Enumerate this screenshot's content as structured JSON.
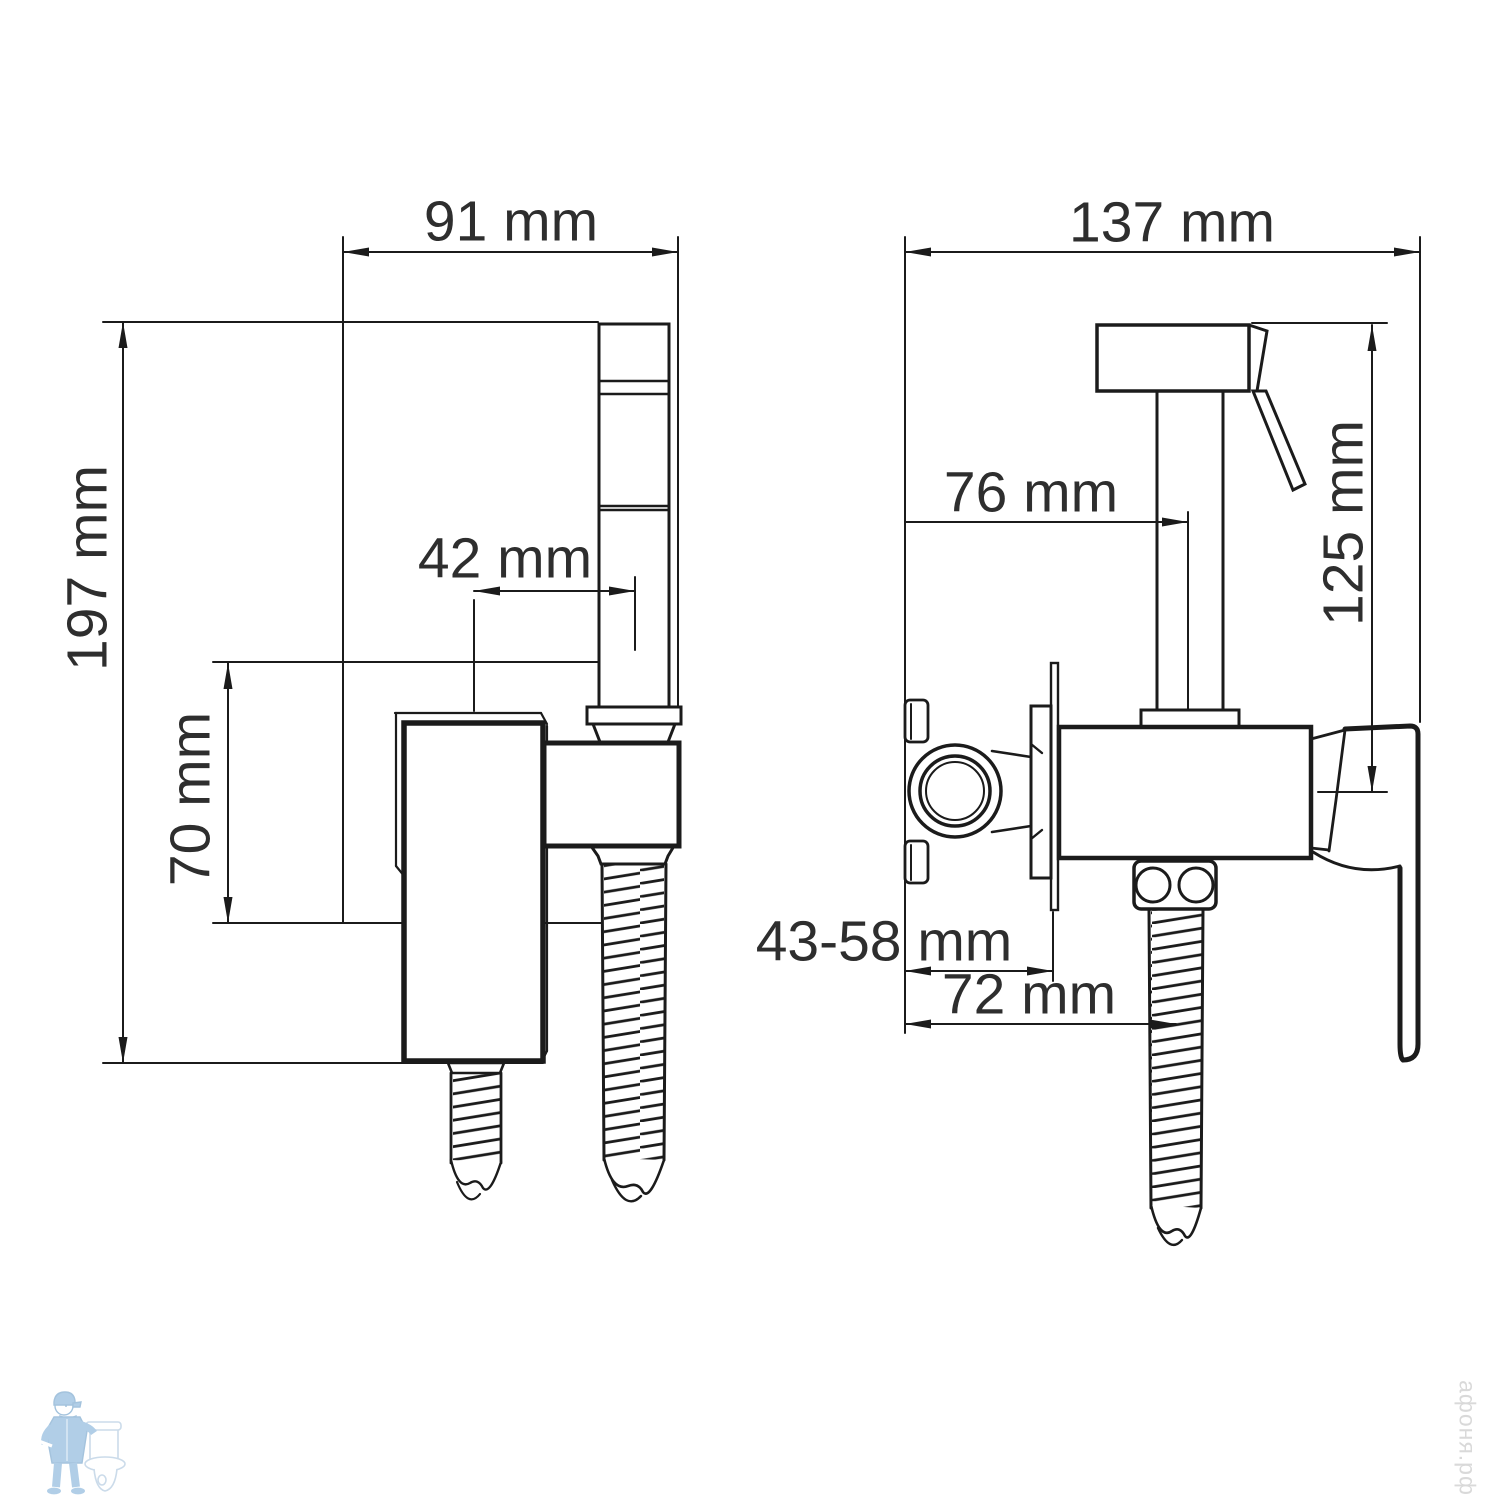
{
  "colors": {
    "line": "#1b1b1b",
    "label_text": "#2e2e2e",
    "watermark_text": "#d9d9d9",
    "logo_blue": "#a9c9e5"
  },
  "views": {
    "front": {
      "dims": {
        "width": "91 mm",
        "height": "197 mm",
        "spout_offset": "42 mm",
        "plate_height": "70 mm"
      }
    },
    "side": {
      "dims": {
        "width": "137 mm",
        "spout_reach": "76 mm",
        "sprayer_height": "125 mm",
        "wall_depth": "43-58 mm",
        "hose_offset": "72 mm"
      }
    }
  },
  "watermark": {
    "text": "афоня.рф"
  },
  "logo": {
    "icon": "plumber-with-toilet"
  }
}
